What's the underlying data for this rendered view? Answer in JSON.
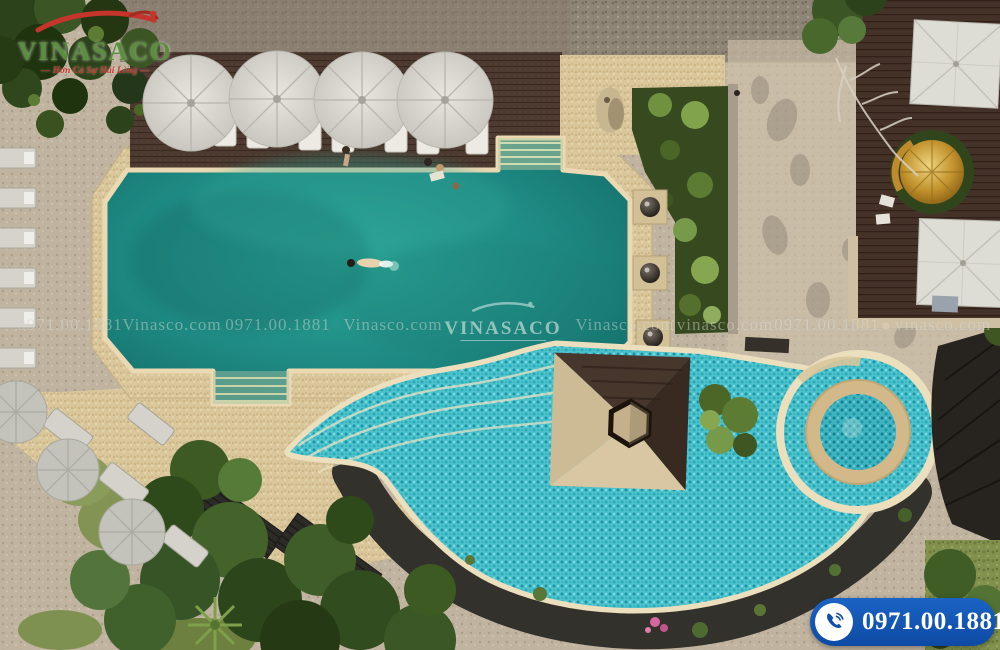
{
  "branding": {
    "logo_text": "VINASACO",
    "logo_tagline": "— Hơn Cả Sự Hài Lòng —"
  },
  "watermarks": {
    "center_logo_text": "VINASACO",
    "items": [
      {
        "text": "0971.00.1881"
      },
      {
        "text": "Vinasco.com"
      },
      {
        "text": "0971.00.1881"
      },
      {
        "text": "Vinasco.com"
      },
      {
        "text": "Vinasco.com"
      },
      {
        "text": "vinasco.com"
      },
      {
        "text": "0971.00.1881"
      },
      {
        "text": "vinasco.com"
      }
    ]
  },
  "contact_badge": {
    "phone": "0971.00.1881",
    "icon": "phone-icon"
  },
  "colors": {
    "badge_blue": "#1155b4",
    "logo_green": "#5a8f3c",
    "logo_red": "#c5352b",
    "pool_teal": "#1f8b84",
    "river_cyan": "#45bfca",
    "spa_ring_tan": "#d3b88a",
    "sandstone": "#d9c69b",
    "deck_brown": "#4c392f"
  }
}
